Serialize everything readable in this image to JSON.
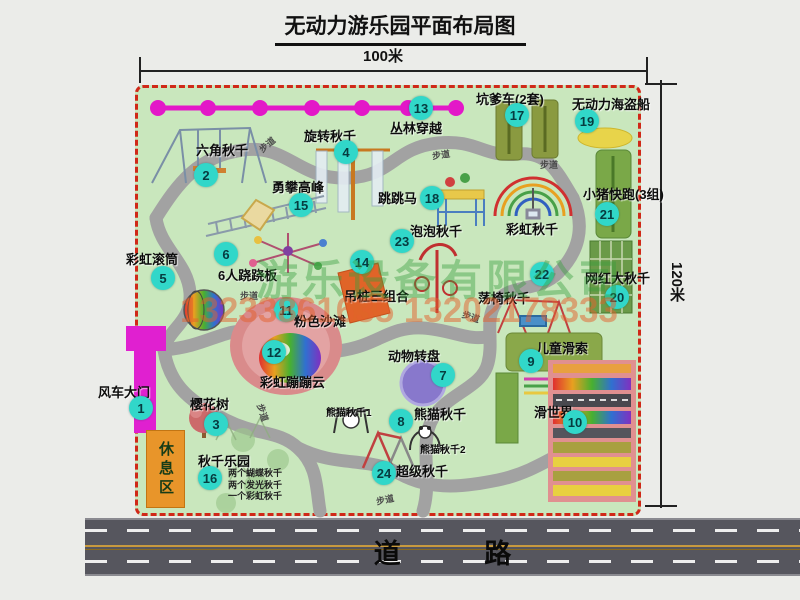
{
  "title": "无动力游乐园平面布局图",
  "dimensions": {
    "top": "100米",
    "right": "120米"
  },
  "watermark": {
    "company": "游乐设备有限公司",
    "phone": "13233861635 13202178333"
  },
  "road": {
    "label": "道 路"
  },
  "map": {
    "path_label": "步道",
    "rest_area": "休息区",
    "rainbow_swing": "彩虹秋千",
    "panda_sub1": "熊猫秋千1",
    "panda_sub2": "熊猫秋千2",
    "swing_park_items": [
      "两个蝴蝶秋千",
      "两个发光秋千",
      "一个彩虹秋千"
    ],
    "attractions": [
      {
        "num": "1",
        "name": "风车大门"
      },
      {
        "num": "2",
        "name": "六角秋千"
      },
      {
        "num": "3",
        "name": "樱花树"
      },
      {
        "num": "4",
        "name": "旋转秋千"
      },
      {
        "num": "5",
        "name": "彩虹滚筒"
      },
      {
        "num": "6",
        "name": "6人跷跷板"
      },
      {
        "num": "7",
        "name": "动物转盘"
      },
      {
        "num": "8",
        "name": "熊猫秋千"
      },
      {
        "num": "9",
        "name": "儿童滑索"
      },
      {
        "num": "10",
        "name": "滑世界"
      },
      {
        "num": "11",
        "name": "粉色沙滩"
      },
      {
        "num": "12",
        "name": "彩虹蹦蹦云"
      },
      {
        "num": "13",
        "name": "丛林穿越"
      },
      {
        "num": "14",
        "name": "吊桩三组合"
      },
      {
        "num": "15",
        "name": "勇攀高峰"
      },
      {
        "num": "16",
        "name": "秋千乐园"
      },
      {
        "num": "17",
        "name": "坑爹车(2套)"
      },
      {
        "num": "18",
        "name": "跳跳马"
      },
      {
        "num": "19",
        "name": "无动力海盗船"
      },
      {
        "num": "20",
        "name": "网红大秋千"
      },
      {
        "num": "21",
        "name": "小猪快跑(3组)"
      },
      {
        "num": "22",
        "name": "荡椅秋千"
      },
      {
        "num": "23",
        "name": "泡泡秋千"
      },
      {
        "num": "24",
        "name": "超级秋千"
      }
    ]
  },
  "colors": {
    "map_green": "#c9e7bd",
    "border_red": "#d02818",
    "badge_cyan": "#31d7c9",
    "zipline_magenta": "#e318c8",
    "road_gray": "#56565e",
    "rest_orange": "#e8952a"
  }
}
